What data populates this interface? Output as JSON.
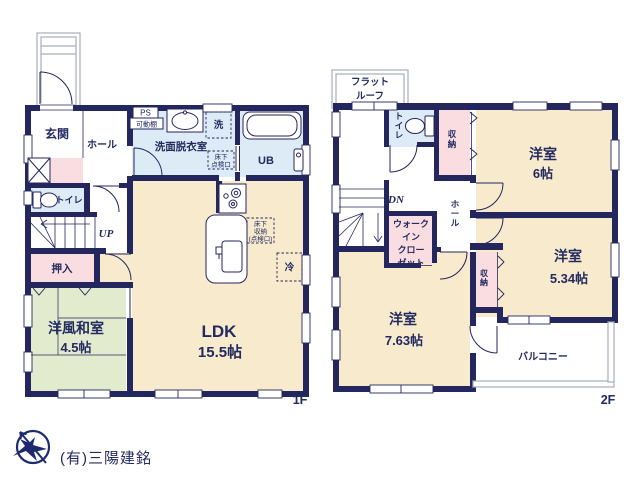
{
  "company": "(有)三陽建銘",
  "floors": {
    "f1": {
      "label": "1F",
      "genkan": "玄関",
      "hall": "ホール",
      "toilet": "トイレ",
      "stairs": "UP",
      "oshiire": "押入",
      "washitsu": "洋風和室",
      "washitsu_size": "4.5帖",
      "ldk": "LDK",
      "ldk_size": "15.5帖",
      "senmen": "洗面脱衣室",
      "ub": "UB",
      "ps": "PS",
      "kadodana": "可動棚",
      "washer": "洗",
      "tenken_l1": "床下",
      "tenken_l2": "点検口",
      "shuno_l1": "床下",
      "shuno_l2": "収納",
      "shuno_l3": "(点検口)",
      "fridge": "冷"
    },
    "f2": {
      "label": "2F",
      "flatroof_l1": "フラット",
      "flatroof_l2": "ルーフ",
      "toilet": "トイレ",
      "closet_a": "収納",
      "room6": "洋室",
      "room6_size": "6帖",
      "stairs": "DN",
      "hall": "ホール",
      "wic_l1": "ウォーク",
      "wic_l2": "イン",
      "wic_l3": "クロー",
      "wic_l4": "ゼット",
      "room763": "洋室",
      "room763_size": "7.63帖",
      "closet_b": "収納",
      "room534": "洋室",
      "room534_size": "5.34帖",
      "balcony": "バルコニー"
    }
  },
  "colors": {
    "wall": "#24265e",
    "room_cream": "#f8ebcd",
    "room_blue": "#dcebf5",
    "room_pink": "#fadde1",
    "room_green": "#e3ebcf",
    "outline_gray": "#a8adba",
    "logo_gray": "#cbcbcb"
  }
}
